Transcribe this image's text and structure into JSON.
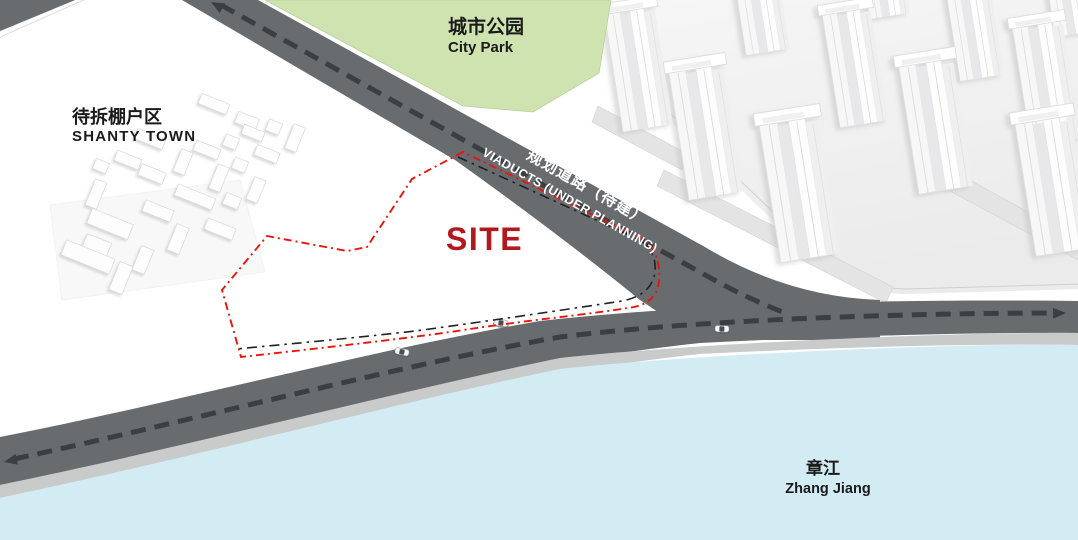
{
  "map": {
    "site_label": "SITE",
    "city_park": {
      "zh": "城市公园",
      "en": "City Park"
    },
    "shanty_town": {
      "zh": "待拆棚户区",
      "en": "SHANTY  TOWN"
    },
    "river": {
      "zh": "章江",
      "en": "Zhang Jiang"
    },
    "planned_road": {
      "zh": "规划道路（待建）",
      "en": "VIADUCTS (UNDER PLANNING)"
    }
  },
  "colors": {
    "park_green": "#cfe3b0",
    "river_blue": "#d3ecf4",
    "road_gray": "#686c6f",
    "embankment_gray": "#c9cbcb",
    "site_red": "#b2191d",
    "boundary_red": "#e8150c",
    "lane_dash": "#3b3e42",
    "label_black": "#1a1a1a"
  }
}
